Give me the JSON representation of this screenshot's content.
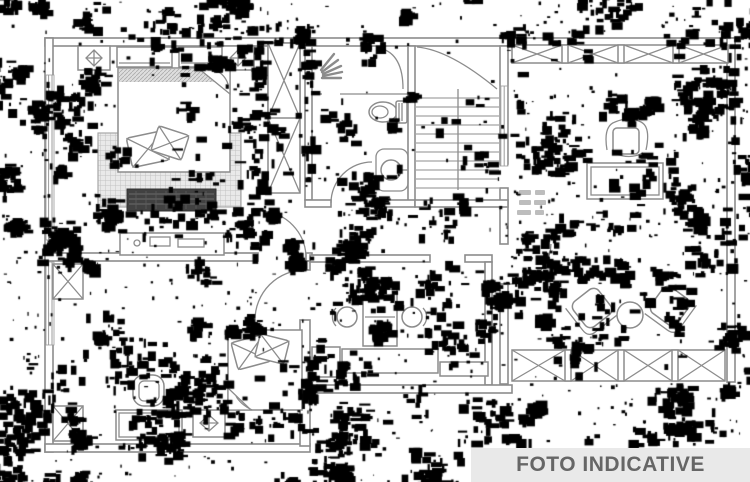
{
  "banner": {
    "label": "FOTO INDICATIVE",
    "background": "#e9e9e9",
    "text_color": "#666666"
  },
  "plan": {
    "background": "#ffffff",
    "line_color": "#8c8c8c",
    "noise_color": "#000000",
    "dark_fill": "#414141",
    "fixtures": [
      "ceiling-light-icon",
      "wall-cabinet",
      "wardrobe",
      "double-bed",
      "throw-pillows",
      "area-rug",
      "storage-bench",
      "sideboard",
      "shower",
      "shower-spray-icon",
      "toilet-icon",
      "washbasin-icon",
      "staircase",
      "window-railing",
      "desk",
      "office-chair-icon",
      "armchair-icon",
      "coffee-table",
      "vanity-counter",
      "twin-washbasins",
      "bathroom-cabinet",
      "single-bed",
      "bedroom-armchair",
      "dresser",
      "radiator",
      "door-swing"
    ]
  }
}
